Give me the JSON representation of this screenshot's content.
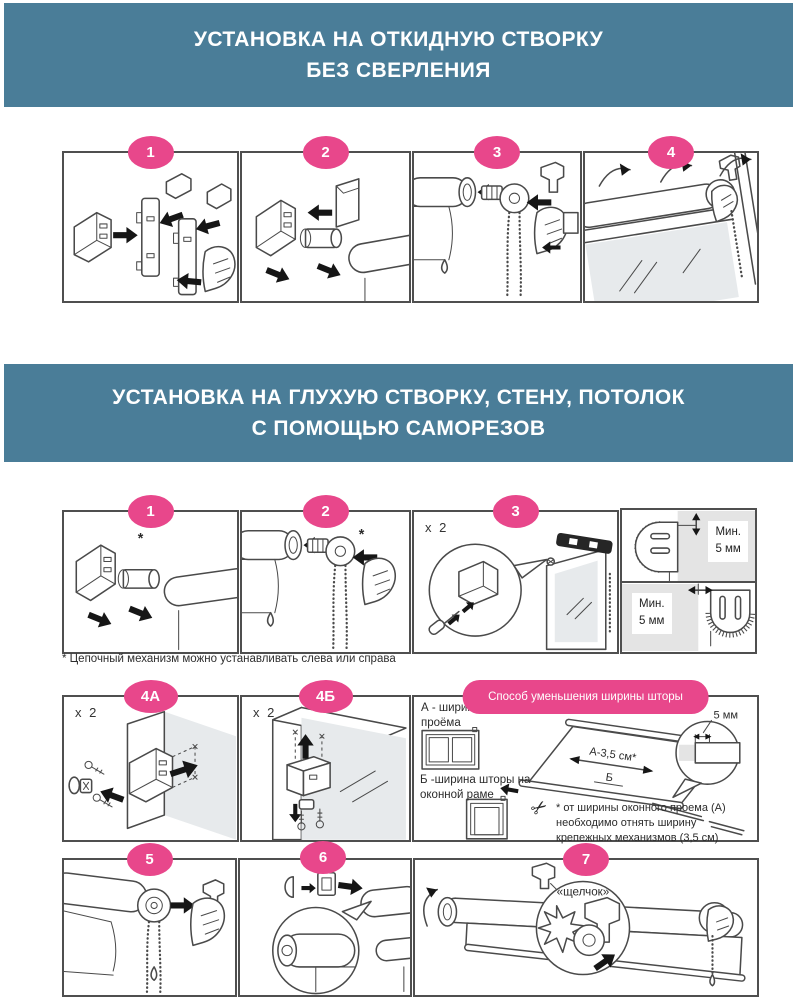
{
  "colors": {
    "banner_bg": "#4A7D98",
    "accent_pink": "#E8478B",
    "panel_border": "#4F4F4F"
  },
  "banner1": {
    "line1": "УСТАНОВКА НА ОТКИДНУЮ СТВОРКУ",
    "line2": "БЕЗ СВЕРЛЕНИЯ"
  },
  "banner2": {
    "line1": "УСТАНОВКА НА ГЛУХУЮ СТВОРКУ, СТЕНУ, ПОТОЛОК",
    "line2": "С ПОМОЩЬЮ САМОРЕЗОВ"
  },
  "section1": {
    "badges": [
      "1",
      "2",
      "3",
      "4"
    ]
  },
  "section2": {
    "badges_row1": [
      "1",
      "2",
      "3"
    ],
    "x2": "x 2",
    "asterisk": "*",
    "min_clearance": {
      "line1": "Мин.",
      "line2": "5 мм"
    },
    "note": "* Цепочный механизм можно устанавливать слева или справа",
    "badges_row2": [
      "4А",
      "4Б"
    ],
    "width_reduction": {
      "title": "Способ уменьшения ширины шторы",
      "label_a": "А - ширина оконного проёма",
      "label_b": "Б -ширина шторы на оконной раме",
      "dim_a": "А-3,5 см*",
      "dim_b": "Б",
      "dim_5mm": "5 мм",
      "footnote": "* от ширины оконного проема (А) необходимо отнять ширину крепежных механизмов (3,5 см)"
    },
    "badges_row3": [
      "5",
      "6",
      "7"
    ],
    "click_label": "«щелчок»"
  },
  "icons": {
    "scissors": "✂"
  }
}
